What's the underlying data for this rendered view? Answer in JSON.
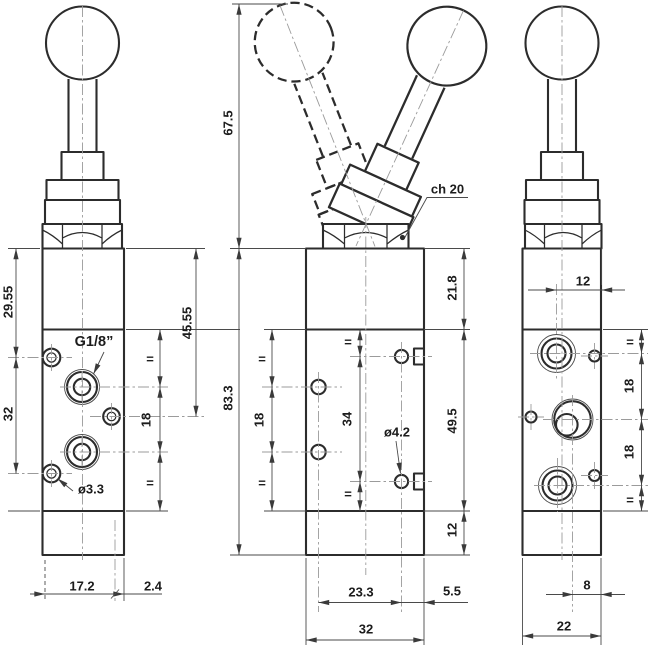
{
  "colors": {
    "line": "#2c2c2c",
    "dimension": "#4a4a4a",
    "centerline": "#9b9b9b",
    "text": "#1c1c1c",
    "background": "#ffffff"
  },
  "views": {
    "left": {
      "dim_top": "29.55",
      "dim_mid": "32",
      "dim_right_total": "45.55",
      "port_pitch": "18",
      "equal_top": "=",
      "equal_bottom": "=",
      "port_thread": "G1/8”",
      "drill": "ø3.3",
      "dim_width": "17.2",
      "dim_offset": "2.4"
    },
    "middle": {
      "lever_height": "67.5",
      "body_height": "83.3",
      "hex_size": "ch 20",
      "dim_top": "21.8",
      "dim_mid": "49.5",
      "dim_bottom": "12",
      "pilot_equal_top": "=",
      "pilot_pitch": "18",
      "pilot_equal_bottom": "=",
      "mount_equal_top": "=",
      "mount_pitch": "34",
      "mount_equal_bottom": "=",
      "mount_drill": "ø4.2",
      "dim_span": "23.3",
      "dim_mount_offset": "5.5",
      "dim_width": "32"
    },
    "right": {
      "dim_port_depth": "12",
      "port_pitch_upper": "18",
      "port_pitch_lower": "18",
      "equal_top": "=",
      "equal_bottom": "=",
      "dim_hole_offset": "8",
      "dim_width": "22"
    }
  }
}
